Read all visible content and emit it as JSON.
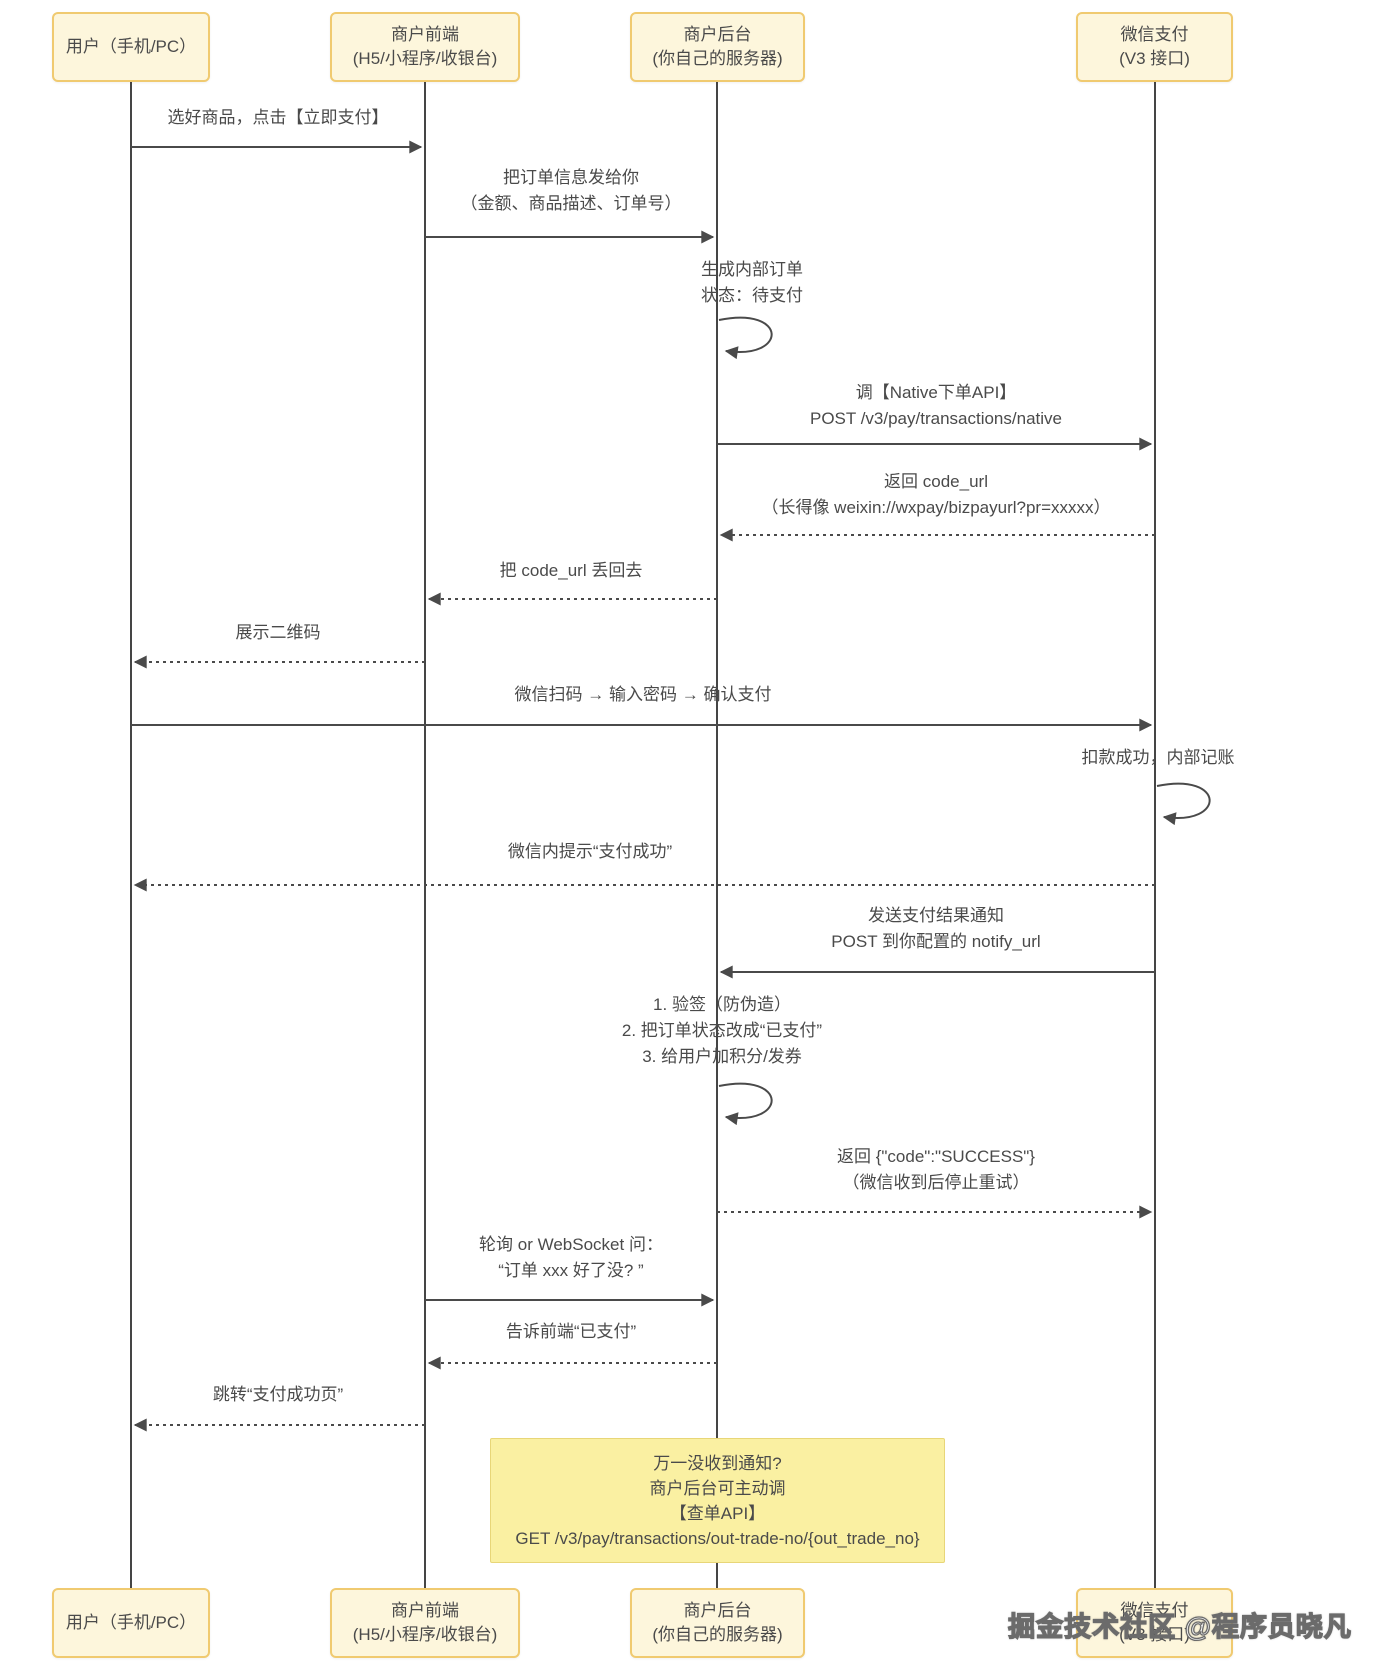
{
  "actors": [
    {
      "id": "user",
      "name": "用户（手机/PC）"
    },
    {
      "id": "frontend",
      "name": "商户前端\n(H5/小程序/收银台)"
    },
    {
      "id": "backend",
      "name": "商户后台\n(你自己的服务器)"
    },
    {
      "id": "wechat",
      "name": "微信支付\n(V3 接口)"
    }
  ],
  "messages": [
    {
      "from": "用户",
      "to": "商户前端",
      "style": "solid",
      "text": "选好商品，点击【立即支付】"
    },
    {
      "from": "商户前端",
      "to": "商户后台",
      "style": "solid",
      "text": "把订单信息发给你\n（金额、商品描述、订单号）"
    },
    {
      "from": "商户后台",
      "to": "商户后台",
      "style": "self",
      "text": "生成内部订单\n状态：待支付"
    },
    {
      "from": "商户后台",
      "to": "微信支付",
      "style": "solid",
      "text": "调【Native下单API】\nPOST /v3/pay/transactions/native"
    },
    {
      "from": "微信支付",
      "to": "商户后台",
      "style": "dashed",
      "text": "返回 code_url\n（长得像 weixin://wxpay/bizpayurl?pr=xxxxx）"
    },
    {
      "from": "商户后台",
      "to": "商户前端",
      "style": "dashed",
      "text": "把 code_url 丢回去"
    },
    {
      "from": "商户前端",
      "to": "用户",
      "style": "dashed",
      "text": "展示二维码"
    },
    {
      "from": "用户",
      "to": "微信支付",
      "style": "solid",
      "text": "微信扫码 → 输入密码 → 确认支付"
    },
    {
      "from": "微信支付",
      "to": "微信支付",
      "style": "self",
      "text": "扣款成功，内部记账"
    },
    {
      "from": "微信支付",
      "to": "用户",
      "style": "dashed",
      "text": "微信内提示“支付成功”"
    },
    {
      "from": "微信支付",
      "to": "商户后台",
      "style": "solid",
      "text": "发送支付结果通知\nPOST 到你配置的 notify_url"
    },
    {
      "from": "商户后台",
      "to": "商户后台",
      "style": "self",
      "text": "1. 验签（防伪造）\n2. 把订单状态改成“已支付”\n3. 给用户加积分/发券"
    },
    {
      "from": "商户后台",
      "to": "微信支付",
      "style": "dashed",
      "text": "返回 {\"code\":\"SUCCESS\"}\n（微信收到后停止重试）"
    },
    {
      "from": "商户前端",
      "to": "商户后台",
      "style": "solid",
      "text": "轮询 or WebSocket 问：\n“订单 xxx 好了没? ”"
    },
    {
      "from": "商户后台",
      "to": "商户前端",
      "style": "dashed",
      "text": "告诉前端“已支付”"
    },
    {
      "from": "商户前端",
      "to": "用户",
      "style": "dashed",
      "text": "跳转“支付成功页”"
    }
  ],
  "note": {
    "text": "万一没收到通知?\n商户后台可主动调\n【查单API】\nGET /v3/pay/transactions/out-trade-no/{out_trade_no}"
  },
  "watermark": "掘金技术社区 @程序员晓凡",
  "colors": {
    "actor_fill": "#fdf6dc",
    "actor_border": "#f0ca70",
    "note_fill": "#faf0a2",
    "line": "#4a4a4a",
    "text": "#4a4a4a",
    "background": "#ffffff"
  }
}
